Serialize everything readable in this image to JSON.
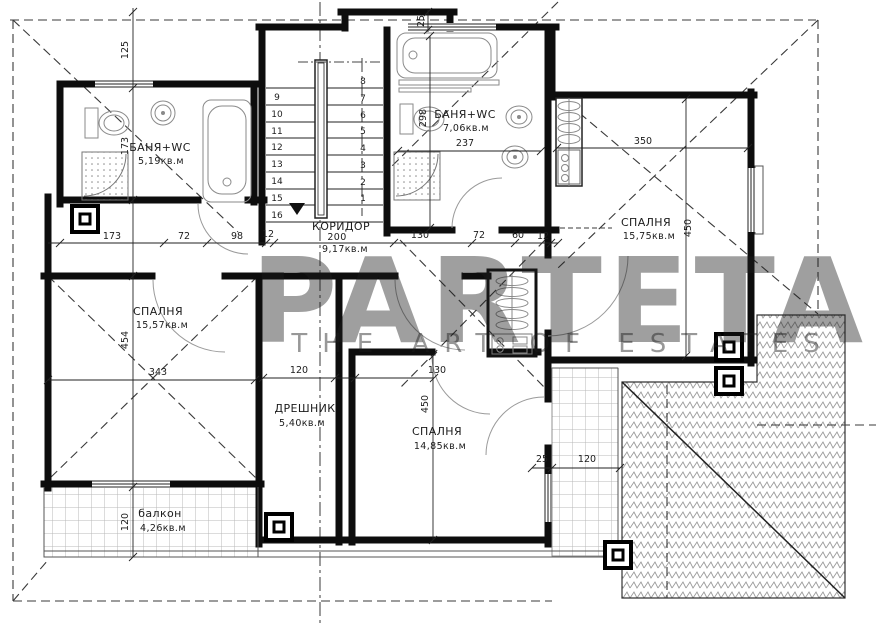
{
  "watermark": {
    "brand": "PARTETA",
    "tagline": "THE ART OF ESTATES"
  },
  "rooms": {
    "bath_top_left": {
      "label": "БАНЯ+WC",
      "area": "5,19кв.м"
    },
    "bath_top_right": {
      "label": "БАНЯ+WC",
      "area": "7,06кв.м"
    },
    "bedroom_right": {
      "label": "СПАЛНЯ",
      "area": "15,75кв.м"
    },
    "bedroom_left": {
      "label": "СПАЛНЯ",
      "area": "15,57кв.м"
    },
    "corridor": {
      "label": "КОРИДОР",
      "width": "200",
      "area": "9,17кв.м"
    },
    "closet": {
      "label": "ДРЕШНИК",
      "area": "5,40кв.м"
    },
    "bedroom_bottom": {
      "label": "СПАЛНЯ",
      "area": "14,85кв.м"
    },
    "balcony": {
      "label": "балкон",
      "area": "4,26кв.м"
    }
  },
  "stairs": {
    "left_steps": [
      "9",
      "10",
      "11",
      "12",
      "13",
      "14",
      "15",
      "16"
    ],
    "right_steps": [
      "8",
      "7",
      "6",
      "5",
      "4",
      "3",
      "2",
      "1"
    ]
  },
  "dims": {
    "eave_top": "125",
    "bath1_h": "173",
    "chain": [
      "173",
      "72",
      "98",
      "12"
    ],
    "chain_r": [
      "130",
      "72",
      "60",
      "12"
    ],
    "bay": "25",
    "bath2_h": "298",
    "bath2_w": "237",
    "br_w": "350",
    "br_h": "450",
    "bl_h": "454",
    "bl_w": "343",
    "closet_w": "120",
    "bb_w": "130",
    "bb_h": "450",
    "balcony_h": "120",
    "terr_a": "25",
    "terr_b": "120"
  },
  "colors": {
    "line": "#1a1a1a",
    "hatch": "#9a9a9a",
    "watermark": "#d9d9d9"
  }
}
